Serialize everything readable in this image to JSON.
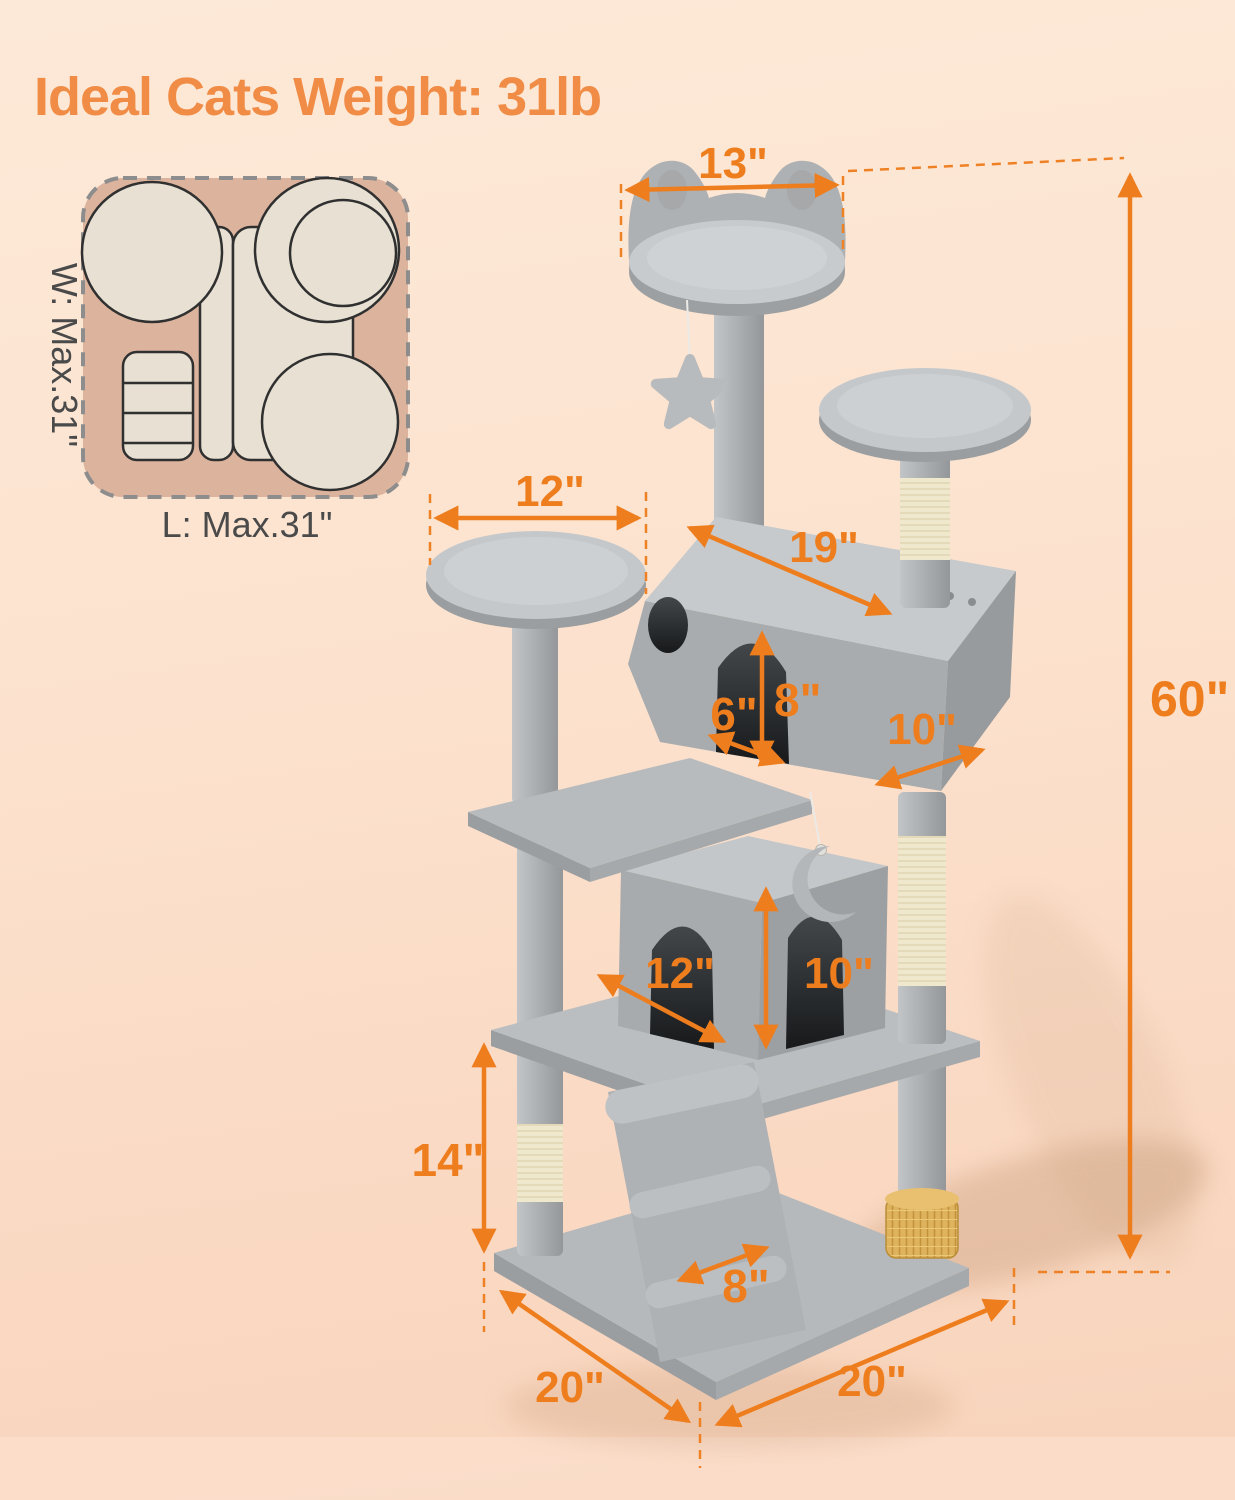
{
  "title": "Ideal Cats Weight: 31lb",
  "footprint": {
    "width_label": "W: Max.31\"",
    "length_label": "L: Max.31\""
  },
  "dims": {
    "top_perch_width": "13\"",
    "left_platform_width": "12\"",
    "condo_length": "19\"",
    "door_width": "6\"",
    "door_height": "8\"",
    "condo_depth": "10\"",
    "cube_width": "12\"",
    "cube_height": "10\"",
    "lower_post_height": "14\"",
    "ramp_width": "8\"",
    "base_side_left": "20\"",
    "base_side_right": "20\"",
    "total_height": "60\""
  },
  "colors": {
    "accent_orange": "#EE7D1E",
    "title_orange": "#F08C45",
    "background_top": "#FDE9D8",
    "background_bottom": "#F8D3BB",
    "tree_gray": "#ABAEB0",
    "tree_gray_light": "#C8CBCD",
    "sisal_cream": "#F0E8CD",
    "brush_gold": "#DBAD58",
    "inset_tan": "#DCB49E",
    "inset_cream": "#E7E0D3",
    "label_dark": "#4A4A4A"
  }
}
